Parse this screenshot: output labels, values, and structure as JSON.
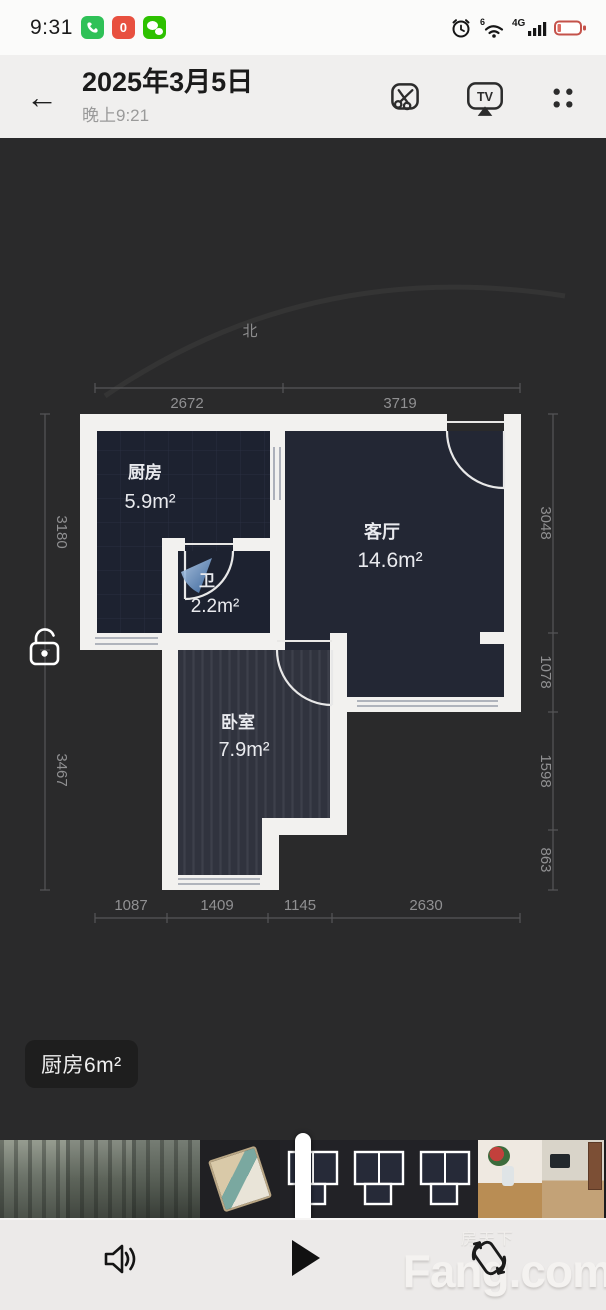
{
  "status_bar": {
    "time": "9:31",
    "badge_zero": "0",
    "wifi_gen": "6",
    "network": "4G"
  },
  "header": {
    "title": "2025年3月5日",
    "subtitle": "晚上9:21",
    "icons": {
      "tv_label": "TV"
    }
  },
  "plan": {
    "compass_label": "北",
    "rooms": {
      "kitchen": {
        "name": "厨房",
        "area": "5.9m²"
      },
      "bath": {
        "name": "卫",
        "area": "2.2m²"
      },
      "living": {
        "name": "客厅",
        "area": "14.6m²"
      },
      "bedroom": {
        "name": "卧室",
        "area": "7.9m²"
      }
    },
    "dims": {
      "top": [
        "2672",
        "3719"
      ],
      "bottom": [
        "1087",
        "1409",
        "1145",
        "2630"
      ],
      "left": [
        "3180",
        "3467"
      ],
      "right": [
        "3048",
        "1078",
        "1598",
        "863"
      ]
    }
  },
  "video": {
    "caption": "厨房6m²"
  },
  "watermark": {
    "brand": "Fang.com",
    "brand_cn": "房天下"
  },
  "colors": {
    "wall_white": "#f2f1ef",
    "room_navy": "#1d2230",
    "living_navy": "#232734",
    "battery_red": "#c4524a",
    "phone_green": "#2fc157",
    "badge_red": "#e8503f",
    "wechat_green": "#2dc100",
    "dim_text_gray": "#909092"
  }
}
